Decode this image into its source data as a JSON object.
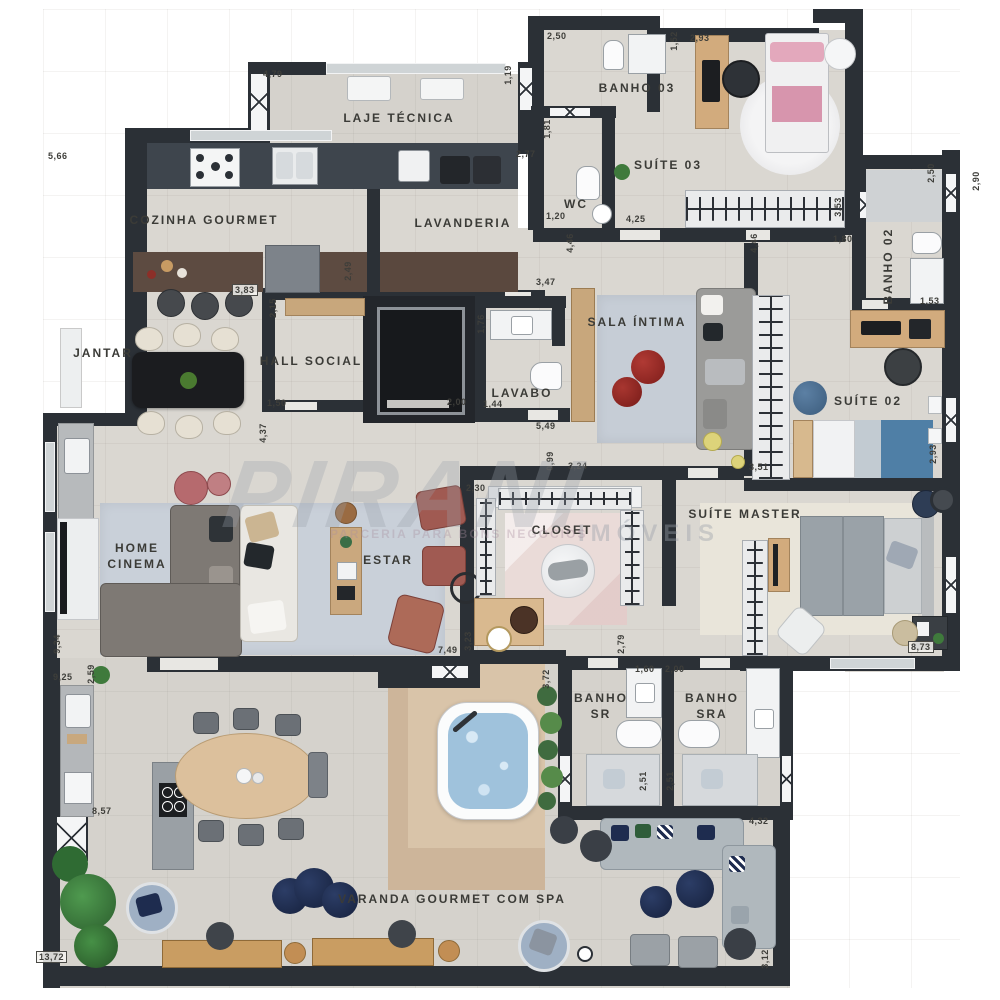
{
  "watermark": {
    "brand": "PIRANI",
    "sub": "IMÓVEIS",
    "tagline": "PARCERIA PARA BONS NEGÓCIOS"
  },
  "rooms": {
    "cozinha": "COZINHA GOURMET",
    "laje": "LAJE TÉCNICA",
    "lavanderia": "LAVANDERIA",
    "banho03": "BANHO 03",
    "suite03": "SUÍTE 03",
    "wc": "WC",
    "banho02": "BANHO 02",
    "sala_intima": "SALA ÍNTIMA",
    "jantar": "JANTAR",
    "hall_social": "HALL SOCIAL",
    "lavabo": "LAVABO",
    "suite02": "SUÍTE 02",
    "home_cinema": "HOME CINEMA",
    "estar": "ESTAR",
    "closet": "CLOSET",
    "suite_master": "SUÍTE MASTER",
    "banho_sr": "BANHO SR",
    "banho_sra": "BANHO SRA",
    "varanda": "VARANDA GOURMET COM SPA"
  },
  "dims": [
    "5,66",
    "4,79",
    "1,19",
    "2,77",
    "2,50",
    "1,52",
    "2,93",
    "1,81",
    "1,20",
    "4,25",
    "3,53",
    "1,80",
    "2,50",
    "2,90",
    "1,53",
    "4,46",
    "4,46",
    "3,47",
    "2,49",
    "2,15",
    "3,83",
    "1,50",
    "4,37",
    "2,00",
    "1,44",
    "1,76",
    "5,49",
    "0,99",
    "3,24",
    "2,30",
    "3,51",
    "2,93",
    "9,34",
    "9,25",
    "2,59",
    "7,49",
    "3,23",
    "2,79",
    "1,60",
    "2,00",
    "2,51",
    "2,51",
    "8,73",
    "8,57",
    "13,72",
    "3,72",
    "4,32",
    "3,12"
  ],
  "palette": {
    "wall": "#2b3036",
    "floor": "#dad7d1",
    "varanda_floor": "#d6d3cd",
    "counter_dark": "#3e454d",
    "wood": "#d2ab7d",
    "island_brown": "#5d4b41",
    "rug_blue": "#c6cdd6",
    "red_pouf": "#8e2320",
    "navy": "#1e2c4f",
    "bed_blue": "#4f7fa6",
    "bed_pink": "#e3a8bc",
    "water": "#9fc2dc",
    "terracotta": "#a05a52",
    "closet_rug": "#eadbd8"
  }
}
